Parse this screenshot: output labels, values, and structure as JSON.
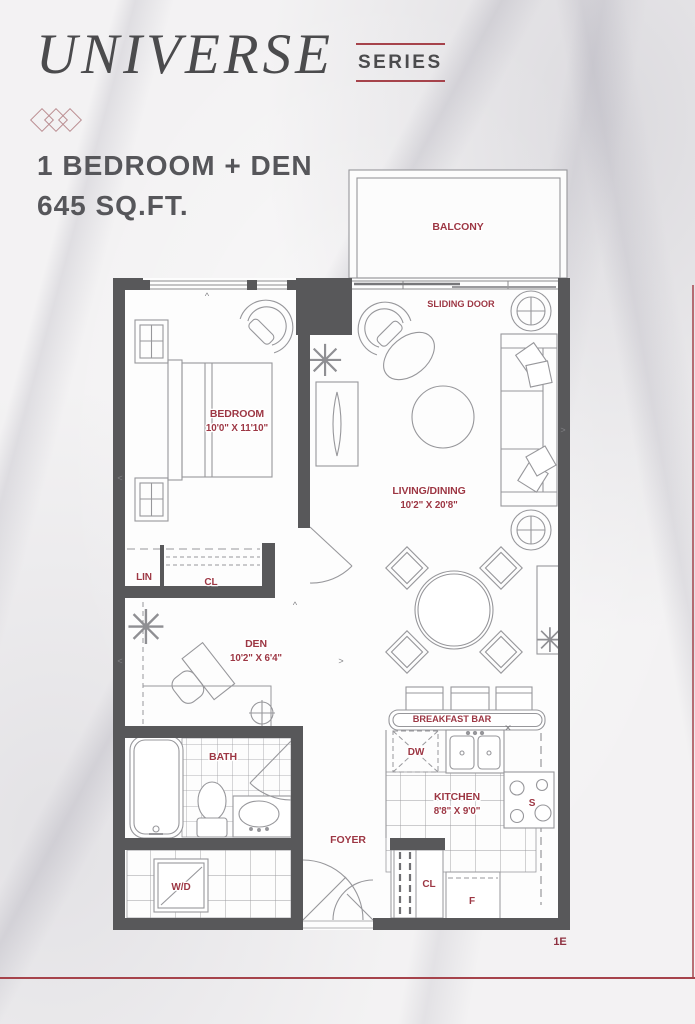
{
  "header": {
    "title": "UNIVERSE",
    "series": "SERIES",
    "unit_type": "1 BEDROOM + DEN",
    "unit_area": "645 SQ.FT."
  },
  "plan": {
    "balcony": "BALCONY",
    "sliding_door": "SLIDING DOOR",
    "rooms": {
      "bedroom": {
        "name": "BEDROOM",
        "dims": "10'0\" X 11'10\""
      },
      "living": {
        "name": "LIVING/DINING",
        "dims": "10'2\" X 20'8\""
      },
      "den": {
        "name": "DEN",
        "dims": "10'2\" X 6'4\""
      },
      "kitchen": {
        "name": "KITCHEN",
        "dims": "8'8\" X 9'0\""
      }
    },
    "labels": {
      "bath": "BATH",
      "foyer": "FOYER",
      "lin": "LIN",
      "bedroom_closet": "CL",
      "foyer_closet": "CL",
      "dishwasher": "DW",
      "washer_dryer": "W/D",
      "stove": "S",
      "fridge": "F",
      "breakfast_bar": "BREAKFAST BAR"
    },
    "unit_code": "1E"
  },
  "icons": {
    "plant": "✳",
    "x_mark": "✕",
    "arrow_left": "<",
    "arrow_right": ">",
    "caret": "^"
  },
  "colors": {
    "accent_red": "#9d3744",
    "rule_red": "#a6434b",
    "wall_gray": "#58585a",
    "line_gray": "#96969a",
    "title_gray": "#4b4b4d"
  }
}
